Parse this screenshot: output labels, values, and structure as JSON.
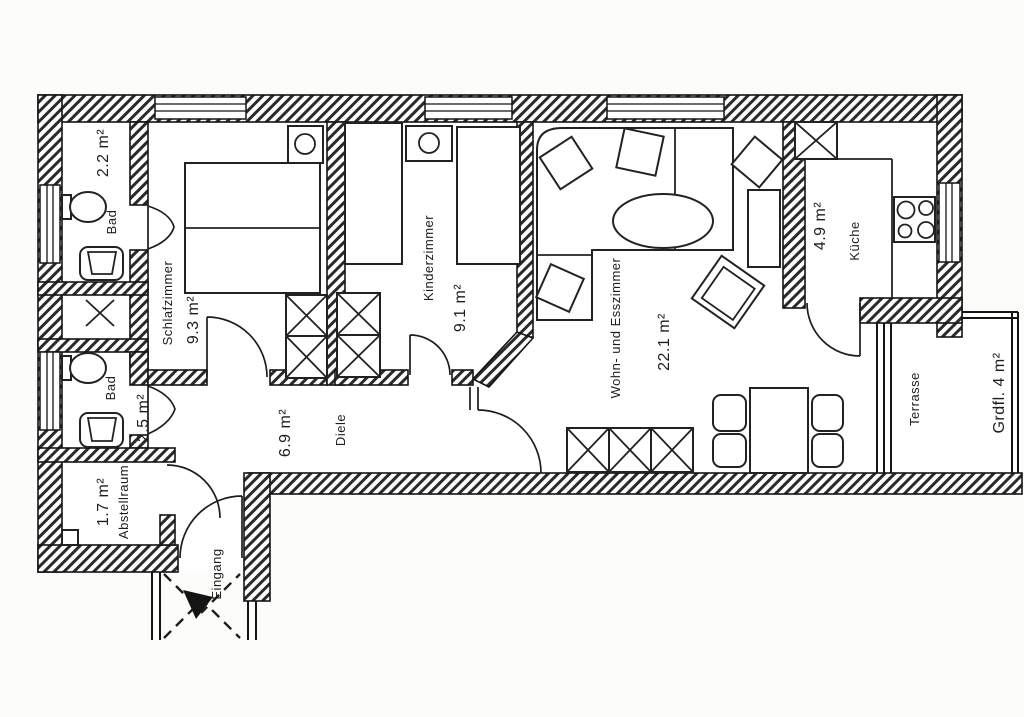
{
  "plan": {
    "colors": {
      "ink": "#1d1d1d",
      "paper": "#fcfcfa"
    },
    "rooms": {
      "bad_top": {
        "name": "Bad",
        "area": "2.2 m²"
      },
      "schlafzimmer": {
        "name": "Schlafzimmer",
        "area": "9.3 m²"
      },
      "kinderzimmer": {
        "name": "Kinderzimmer",
        "area": "9.1 m²"
      },
      "wohn_esszimmer": {
        "name": "Wohn- und Esszimmer",
        "area": "22.1 m²"
      },
      "kueche": {
        "name": "Küche",
        "area": "4.9 m²"
      },
      "terrasse": {
        "name": "Terrasse",
        "area": "Grdfl. 4 m²"
      },
      "diele": {
        "name": "Diele",
        "area": "6.9 m²"
      },
      "bad_bottom": {
        "name": "Bad",
        "area": "2.5 m²"
      },
      "abstellraum": {
        "name": "Abstellraum",
        "area": "1.7 m²"
      },
      "eingang": {
        "name": "Eingang"
      }
    }
  }
}
